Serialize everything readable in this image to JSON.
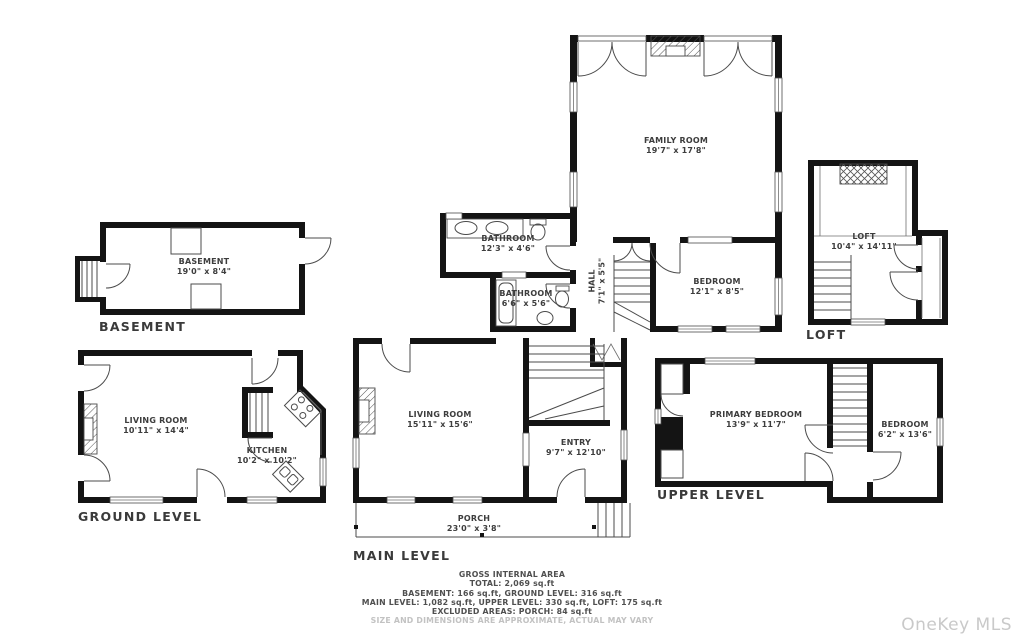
{
  "levels": {
    "basement": {
      "label": "BASEMENT",
      "rooms": [
        {
          "name": "BASEMENT",
          "dims": "19'0\" x 8'4\""
        }
      ]
    },
    "ground": {
      "label": "GROUND LEVEL",
      "rooms": [
        {
          "name": "LIVING ROOM",
          "dims": "10'11\" x 14'4\""
        },
        {
          "name": "KITCHEN",
          "dims": "10'2\" x 10'2\""
        }
      ]
    },
    "main": {
      "label": "MAIN LEVEL",
      "rooms": [
        {
          "name": "FAMILY ROOM",
          "dims": "19'7\" x 17'8\""
        },
        {
          "name": "BEDROOM",
          "dims": "12'1\" x 8'5\""
        },
        {
          "name": "BATHROOM",
          "dims": "12'3\" x 4'6\""
        },
        {
          "name": "BATHROOM",
          "dims": "6'6\" x 5'6\""
        },
        {
          "name": "HALL",
          "dims": "7'1\" x 5'5\""
        },
        {
          "name": "LIVING ROOM",
          "dims": "15'11\" x 15'6\""
        },
        {
          "name": "ENTRY",
          "dims": "9'7\" x 12'10\""
        },
        {
          "name": "PORCH",
          "dims": "23'0\" x 3'8\""
        }
      ]
    },
    "upper": {
      "label": "UPPER LEVEL",
      "rooms": [
        {
          "name": "PRIMARY BEDROOM",
          "dims": "13'9\" x 11'7\""
        },
        {
          "name": "BEDROOM",
          "dims": "6'2\" x 13'6\""
        }
      ]
    },
    "loft": {
      "label": "LOFT",
      "rooms": [
        {
          "name": "LOFT",
          "dims": "10'4\" x 14'11\""
        }
      ]
    }
  },
  "summary": {
    "title": "GROSS INTERNAL AREA",
    "total": "TOTAL: 2,069 sq.ft",
    "line1": "BASEMENT: 166 sq.ft, GROUND LEVEL: 316 sq.ft",
    "line2": "MAIN LEVEL: 1,082 sq.ft, UPPER LEVEL: 330 sq.ft, LOFT: 175 sq.ft",
    "line3": "EXCLUDED AREAS: PORCH: 84 sq.ft",
    "disclaimer": "SIZE AND DIMENSIONS ARE APPROXIMATE, ACTUAL MAY VARY"
  },
  "watermark": "OneKey MLS",
  "colors": {
    "wall": "#141414",
    "thin_line": "#4b4b4b",
    "label_text": "#3d3d3d",
    "summary_text": "#4f4f4f",
    "disclaimer_text": "#c2c2c2",
    "watermark_text": "#c9c9c9",
    "background": "#ffffff"
  }
}
